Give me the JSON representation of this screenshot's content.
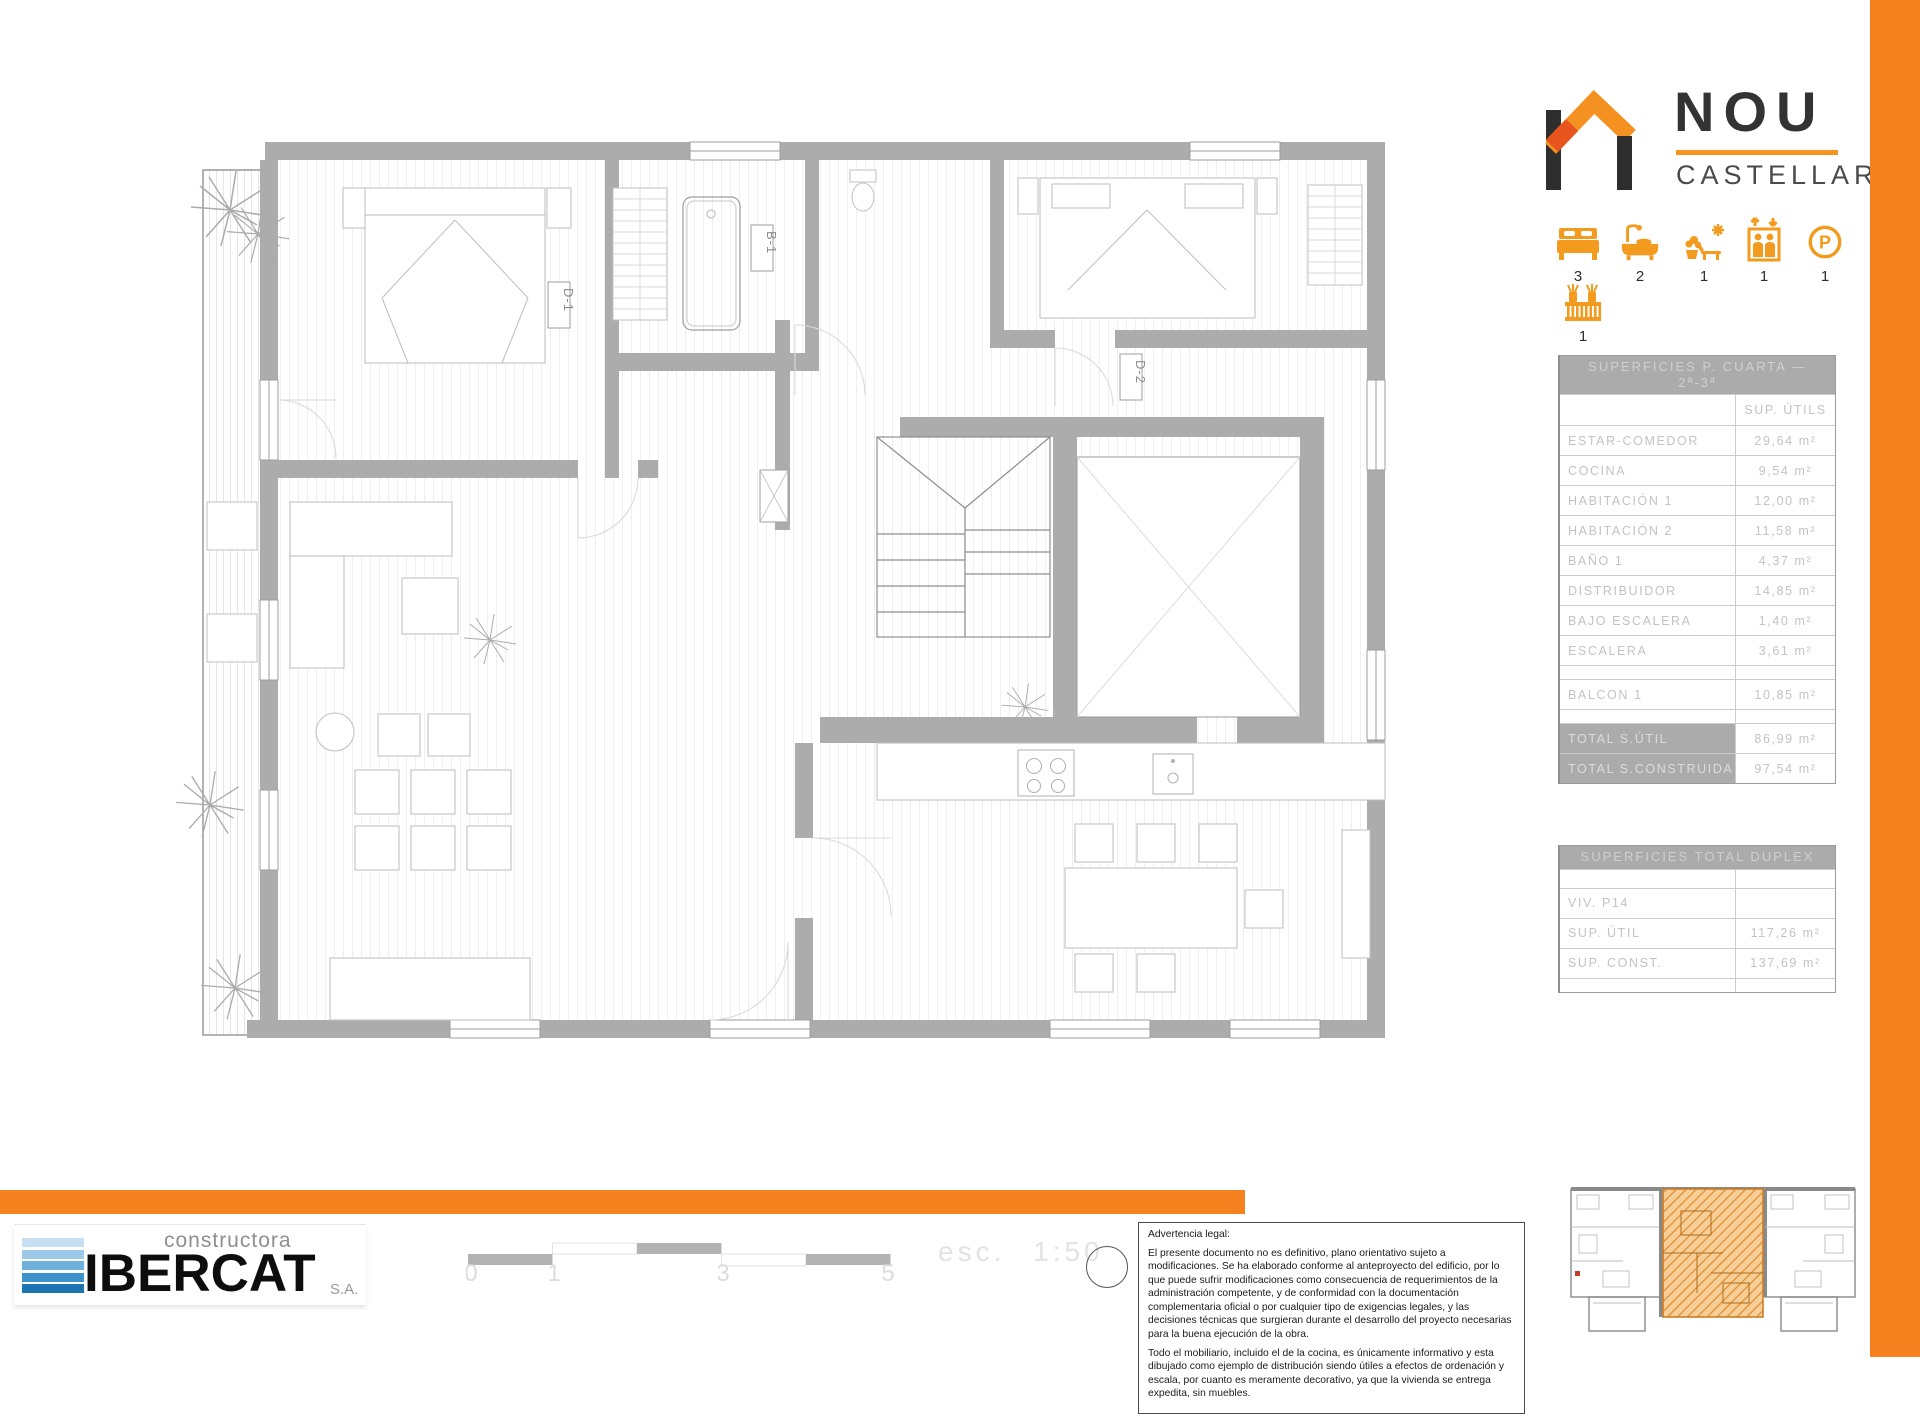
{
  "colors": {
    "accent_orange": "#F5821F",
    "icon_orange": "#F29B1E",
    "wall_gray": "#ACACAC"
  },
  "brand": {
    "title": "NOU",
    "subtitle": "CASTELLAR"
  },
  "amenities": [
    {
      "icon": "bed-icon",
      "count": "3"
    },
    {
      "icon": "bathtub-icon",
      "count": "2"
    },
    {
      "icon": "terrace-icon",
      "count": "1"
    },
    {
      "icon": "elevator-icon",
      "count": "1"
    },
    {
      "icon": "parking-icon",
      "count": "1"
    },
    {
      "icon": "balcony-railing-icon",
      "count": "1"
    }
  ],
  "surfaces_table": {
    "title_line1": "SUPERFICIES P. CUARTA —",
    "title_line2": "2ª-3ª",
    "col_header": "SUP. ÚTILS",
    "rows": [
      {
        "label": "ESTAR-COMEDOR",
        "value": "29,64 m²"
      },
      {
        "label": "COCINA",
        "value": "9,54 m²"
      },
      {
        "label": "HABITACIÓN 1",
        "value": "12,00 m²"
      },
      {
        "label": "HABITACIÓN 2",
        "value": "11,58 m²"
      },
      {
        "label": "BAÑO 1",
        "value": "4,37 m²"
      },
      {
        "label": "DISTRIBUIDOR",
        "value": "14,85 m²"
      },
      {
        "label": "BAJO ESCALERA",
        "value": "1,40 m²"
      },
      {
        "label": "ESCALERA",
        "value": "3,61 m²"
      },
      {
        "label": "BALCON 1",
        "value": "10,85 m²"
      }
    ],
    "totals": [
      {
        "label": "TOTAL S.ÚTIL",
        "value": "86,99 m²"
      },
      {
        "label": "TOTAL S.CONSTRUIDA",
        "value": "97,54 m²"
      }
    ]
  },
  "duplex_table": {
    "title": "SUPERFICIES TOTAL DUPLEX",
    "rows": [
      {
        "label": "VIV. P14",
        "value": ""
      },
      {
        "label": "SUP. ÚTIL",
        "value": "117,26 m²"
      },
      {
        "label": "SUP. CONST.",
        "value": "137,69 m²"
      }
    ]
  },
  "plan_labels": {
    "d1": "D-1",
    "b1": "B-1",
    "d2": "D-2"
  },
  "scalebar": {
    "ticks": [
      "0",
      "1",
      "3",
      "5"
    ],
    "scale_text": "esc. 1:50"
  },
  "legal": {
    "title": "Advertencia legal:",
    "p1": "El presente documento no es definitivo, plano orientativo sujeto a modificaciones. Se ha elaborado conforme al anteproyecto del edificio, por lo que puede sufrir modificaciones como consecuencia de requerimientos de la administración competente, y de conformidad con la documentación complementaria oficial o por cualquier tipo de exigencias legales, y las decisiones técnicas que surgieran durante el desarrollo del proyecto necesarias para la buena ejecución de la obra.",
    "p2": "Todo el mobiliario, incluido el de la cocina, es únicamente informativo y esta dibujado como ejemplo de distribución siendo útiles a efectos de ordenación y escala, por cuanto es meramente decorativo, ya que la vivienda se entrega expedita, sin muebles."
  },
  "footer_brand": {
    "line": "constructora",
    "name": "IBERCAT",
    "suffix": "S.A."
  }
}
